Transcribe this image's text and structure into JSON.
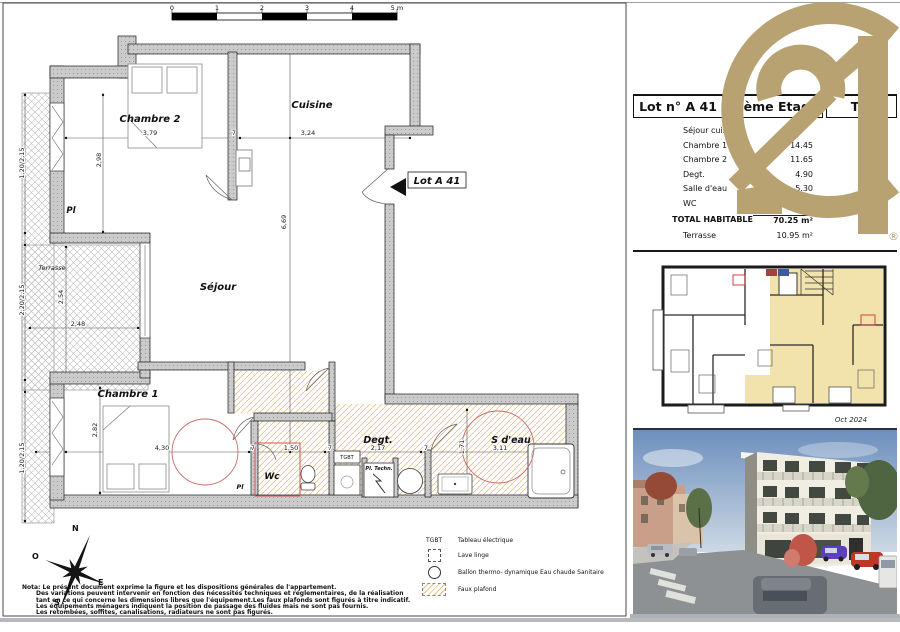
{
  "scale_bar": {
    "labels": [
      "0",
      "1",
      "2",
      "3",
      "4",
      "5 m"
    ]
  },
  "plan": {
    "room_labels": [
      {
        "id": "chambre-2",
        "text": "Chambre 2",
        "x": 150,
        "y": 122,
        "fs": 10
      },
      {
        "id": "cuisine",
        "text": "Cuisine",
        "x": 312,
        "y": 108,
        "fs": 10
      },
      {
        "id": "sejour",
        "text": "Séjour",
        "x": 218,
        "y": 290,
        "fs": 10
      },
      {
        "id": "chambre-1",
        "text": "Chambre 1",
        "x": 128,
        "y": 397,
        "fs": 10
      },
      {
        "id": "terrasse",
        "text": "Terrasse",
        "x": 52,
        "y": 270,
        "fs": 6.5,
        "b": false
      },
      {
        "id": "pl-1",
        "text": "Pl",
        "x": 71,
        "y": 213,
        "fs": 8.5
      },
      {
        "id": "pl-2",
        "text": "Pl",
        "x": 240,
        "y": 489,
        "fs": 6.5
      },
      {
        "id": "wc",
        "text": "Wc",
        "x": 272,
        "y": 479,
        "fs": 9
      },
      {
        "id": "degt",
        "text": "Degt.",
        "x": 378,
        "y": 443,
        "fs": 9.5
      },
      {
        "id": "s-deau",
        "text": "S d'eau",
        "x": 511,
        "y": 443,
        "fs": 9.5
      },
      {
        "id": "pl-techn",
        "text": "Pl. Techn.",
        "x": 379,
        "y": 470,
        "fs": 5
      },
      {
        "id": "tgbt",
        "text": "TGBT",
        "x": 347,
        "y": 459,
        "fs": 5,
        "it": false,
        "b": false
      },
      {
        "id": "lot-tag",
        "text": "Lot  A 41",
        "x": 437,
        "y": 184,
        "fs": 10
      }
    ],
    "dim_labels": [
      {
        "text": "3,79",
        "x": 150,
        "y": 135
      },
      {
        "text": "7",
        "x": 234,
        "y": 135
      },
      {
        "text": "3,24",
        "x": 308,
        "y": 135
      },
      {
        "text": "2,98",
        "x": 101,
        "y": 160,
        "rot": -90
      },
      {
        "text": "6,69",
        "x": 286,
        "y": 222,
        "rot": -90
      },
      {
        "text": "1,20/2,15",
        "x": 24,
        "y": 163,
        "rot": -90
      },
      {
        "text": "2,20/2,15",
        "x": 24,
        "y": 300,
        "rot": -90
      },
      {
        "text": "2,54",
        "x": 63,
        "y": 297,
        "rot": -90
      },
      {
        "text": "2,48",
        "x": 78,
        "y": 326
      },
      {
        "text": "2,82",
        "x": 97,
        "y": 430,
        "rot": -90
      },
      {
        "text": "1,20/2,15",
        "x": 24,
        "y": 458,
        "rot": -90
      },
      {
        "text": "4,30",
        "x": 162,
        "y": 450
      },
      {
        "text": "7",
        "x": 253,
        "y": 450
      },
      {
        "text": "1,50",
        "x": 291,
        "y": 450
      },
      {
        "text": "7",
        "x": 330,
        "y": 450
      },
      {
        "text": "2,17",
        "x": 378,
        "y": 450
      },
      {
        "text": "7",
        "x": 426,
        "y": 450
      },
      {
        "text": "3,11",
        "x": 500,
        "y": 450
      },
      {
        "text": "1,71",
        "x": 464,
        "y": 447,
        "rot": -90
      }
    ]
  },
  "compass": {
    "n": "N",
    "e": "E",
    "s": "S",
    "o": "O"
  },
  "legend": {
    "items": [
      {
        "symbol": "TGBT",
        "label": "Tableau électrique"
      },
      {
        "label": "Lave linge"
      },
      {
        "label": "Ballon thermo- dynamique Eau chaude Sanitaire"
      },
      {
        "label": "Faux plafond"
      }
    ]
  },
  "notes": {
    "lines": [
      "Nota: Le présent document exprime la figure et les dispositions générales de l'appartement.",
      "Des variations peuvent intervenir en fonction des nécessités techniques et réglementaires, de la réalisation",
      "tant en ce qui concerne les dimensions libres que l'équipement.Les faux plafonds sont figurés à titre indicatif.",
      "Les équipements ménagers indiquent la position de passage des fluides mais ne sont pas fournis.",
      "Les retombées, soffites, canalisations, radiateurs ne sont pas figurés."
    ]
  },
  "panel": {
    "logo": {
      "registered": "®",
      "gold": "#b8a272"
    },
    "header": {
      "cells": [
        "Lot n° A 41",
        "4 ème Etage",
        "T 3"
      ]
    },
    "areas": {
      "rows": [
        {
          "label": "Séjour cuisine",
          "value": ""
        },
        {
          "label": "Chambre 1",
          "value": "14.45"
        },
        {
          "label": "Chambre 2",
          "value": "11.65"
        },
        {
          "label": "Degt.",
          "value": "4.90"
        },
        {
          "label": "Salle d'eau",
          "value": "5.30"
        },
        {
          "label": "WC",
          "value": ""
        }
      ],
      "total": {
        "label": "TOTAL HABITABLE",
        "value": "70.25 m²"
      },
      "extra": {
        "label": "Terrasse",
        "value": "10.95 m²"
      }
    },
    "thumbnail": {
      "date": "Oct 2024",
      "highlight": "#f2e2ab"
    }
  }
}
